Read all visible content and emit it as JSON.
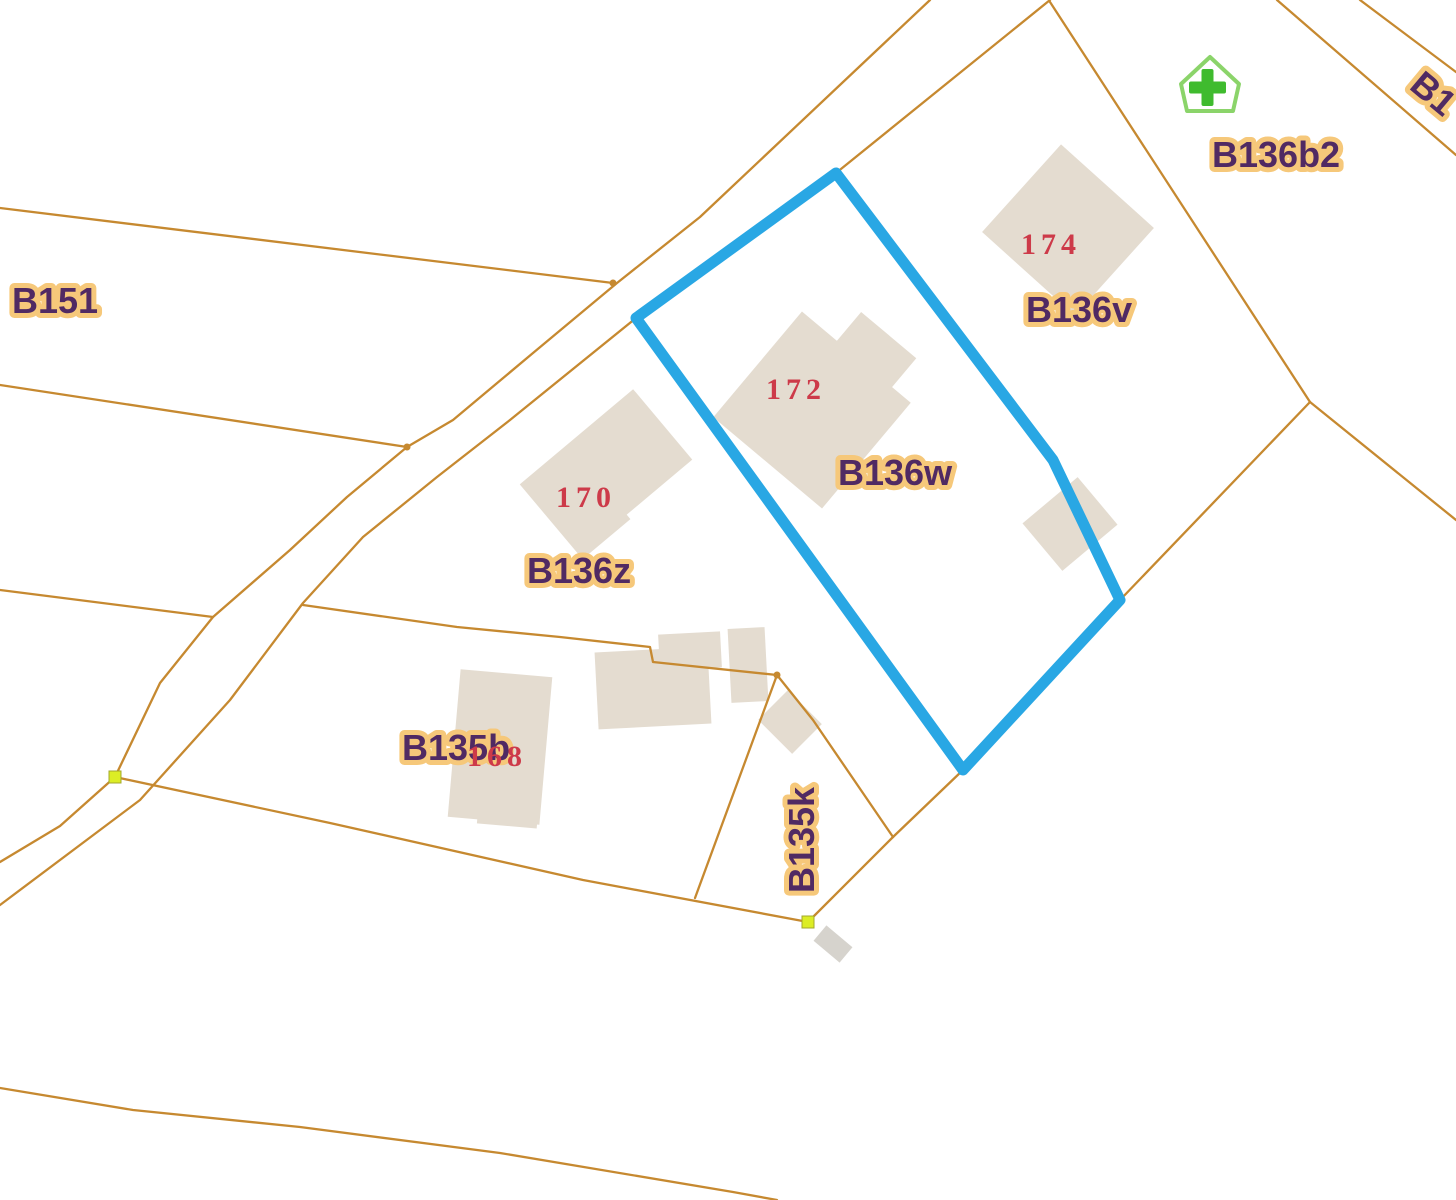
{
  "map": {
    "colors": {
      "boundary": "#c68930",
      "selection": "#29a7e4",
      "building": "#e4dcd0",
      "building_gray": "#d6d3cd",
      "label_text": "#502a63",
      "label_halo": "#f6c87a",
      "house_number": "#cd3a49",
      "survey_marker": "#dced25",
      "poi_green": "#8bd46a",
      "poi_green_dark": "#3fbb2e"
    },
    "selected_parcel": {
      "id": "B136w"
    },
    "parcel_labels": [
      {
        "id": "B151",
        "text": "B151"
      },
      {
        "id": "B136b2",
        "text": "B136b2"
      },
      {
        "id": "B136v",
        "text": "B136v"
      },
      {
        "id": "B136w",
        "text": "B136w"
      },
      {
        "id": "B136z",
        "text": "B136z"
      },
      {
        "id": "B135b",
        "text": "B135b"
      },
      {
        "id": "B135k",
        "text": "B135k"
      },
      {
        "id": "B1",
        "text": "B1"
      }
    ],
    "house_numbers": [
      {
        "value": "174"
      },
      {
        "value": "172"
      },
      {
        "value": "170"
      },
      {
        "value": "168"
      }
    ],
    "poi": {
      "name": "health-facility",
      "symbol": "house-with-green-cross"
    }
  }
}
